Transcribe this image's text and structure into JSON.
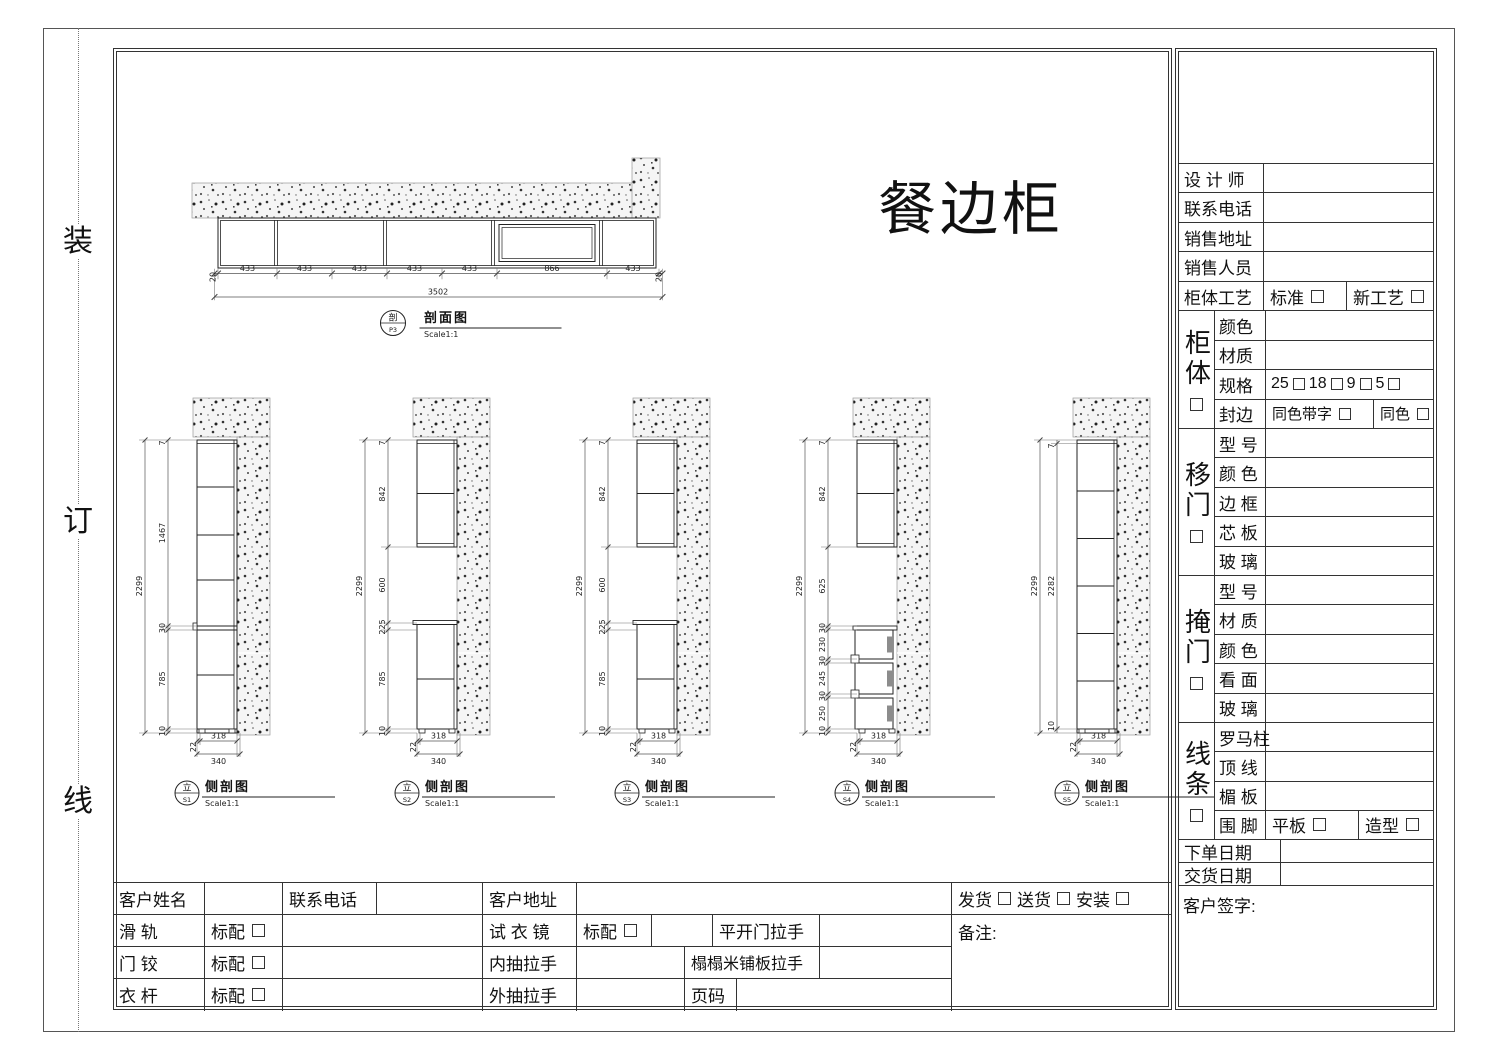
{
  "page": {
    "binding_marks": [
      "装",
      "订",
      "线"
    ]
  },
  "drawing": {
    "main_title": "餐边柜",
    "plan": {
      "tag": "剖",
      "code": "P3",
      "title": "剖面图",
      "scale": "Scale1:1",
      "overall": "3502",
      "segs": [
        "20",
        "433",
        "433",
        "433",
        "433",
        "433",
        "866",
        "433",
        "20"
      ]
    },
    "views": [
      {
        "tag": "立",
        "code": "S1",
        "title": "侧剖图",
        "scale": "Scale1:1",
        "overall": "2299",
        "chain": [
          "7",
          "1467",
          "30",
          "785",
          "10"
        ],
        "bottom": [
          "22",
          "318",
          "340"
        ]
      },
      {
        "tag": "立",
        "code": "S2",
        "title": "侧剖图",
        "scale": "Scale1:1",
        "overall": "2299",
        "chain": [
          "7",
          "842",
          "600",
          "225",
          "785",
          "10"
        ],
        "bottom": [
          "22",
          "318",
          "340"
        ]
      },
      {
        "tag": "立",
        "code": "S3",
        "title": "侧剖图",
        "scale": "Scale1:1",
        "overall": "2299",
        "chain": [
          "7",
          "842",
          "600",
          "225",
          "785",
          "10"
        ],
        "bottom": [
          "22",
          "318",
          "340"
        ]
      },
      {
        "tag": "立",
        "code": "S4",
        "title": "侧剖图",
        "scale": "Scale1:1",
        "overall": "2299",
        "chain": [
          "7",
          "842",
          "625",
          "30",
          "230",
          "30",
          "245",
          "30",
          "250",
          "10"
        ],
        "bottom": [
          "22",
          "318",
          "340"
        ]
      },
      {
        "tag": "立",
        "code": "S5",
        "title": "侧剖图",
        "scale": "Scale1:1",
        "overall": "2299",
        "inner": "2282",
        "top": "7",
        "base": "10",
        "bottom": [
          "22",
          "318",
          "340"
        ]
      }
    ]
  },
  "title_block": {
    "info_rows": [
      {
        "label": "设 计 师"
      },
      {
        "label": "联系电话"
      },
      {
        "label": "销售地址"
      },
      {
        "label": "销售人员"
      }
    ],
    "craft": {
      "label": "柜体工艺",
      "options": [
        {
          "label": "标准"
        },
        {
          "label": "新工艺"
        }
      ]
    },
    "cabinet": {
      "name": "柜体",
      "color_label": "颜色",
      "material_label": "材质",
      "spec_label": "规格",
      "spec_options": [
        {
          "label": "25"
        },
        {
          "label": "18"
        },
        {
          "label": "9"
        },
        {
          "label": "5"
        }
      ],
      "edge_label": "封边",
      "edge_options": [
        {
          "label": "同色带字"
        },
        {
          "label": "同色"
        }
      ]
    },
    "sliding": {
      "name": "移门",
      "rows": [
        {
          "label": "型 号"
        },
        {
          "label": "颜 色"
        },
        {
          "label": "边 框"
        },
        {
          "label": "芯 板"
        },
        {
          "label": "玻 璃"
        }
      ]
    },
    "hinged": {
      "name": "掩门",
      "rows": [
        {
          "label": "型 号"
        },
        {
          "label": "材 质"
        },
        {
          "label": "颜 色"
        },
        {
          "label": "看 面"
        },
        {
          "label": "玻 璃"
        }
      ]
    },
    "molding": {
      "name": "线条",
      "rows": [
        {
          "label": "罗马柱"
        },
        {
          "label": "顶 线"
        },
        {
          "label": "楣 板"
        }
      ],
      "base_label": "围 脚",
      "base_options": [
        {
          "label": "平板"
        },
        {
          "label": "造型"
        }
      ]
    },
    "order_date_label": "下单日期",
    "delivery_date_label": "交货日期",
    "signature_label": "客户签字:"
  },
  "bottom_table": {
    "name_label": "客户姓名",
    "phone_label": "联系电话",
    "address_label": "客户地址",
    "shipping_options": [
      {
        "label": "发货"
      },
      {
        "label": "送货"
      },
      {
        "label": "安装"
      }
    ],
    "note_label": "备注:",
    "rows": [
      {
        "item": "滑 轨",
        "std": "标配",
        "mid_item": "试 衣 镜",
        "mid_std": "标配",
        "extra": "平开门拉手"
      },
      {
        "item": "门 铰",
        "std": "标配",
        "mid_item": "内抽拉手",
        "extra": "榻榻米铺板拉手"
      },
      {
        "item": "衣 杆",
        "std": "标配",
        "mid_item": "外抽拉手",
        "extra": "页码"
      }
    ]
  }
}
